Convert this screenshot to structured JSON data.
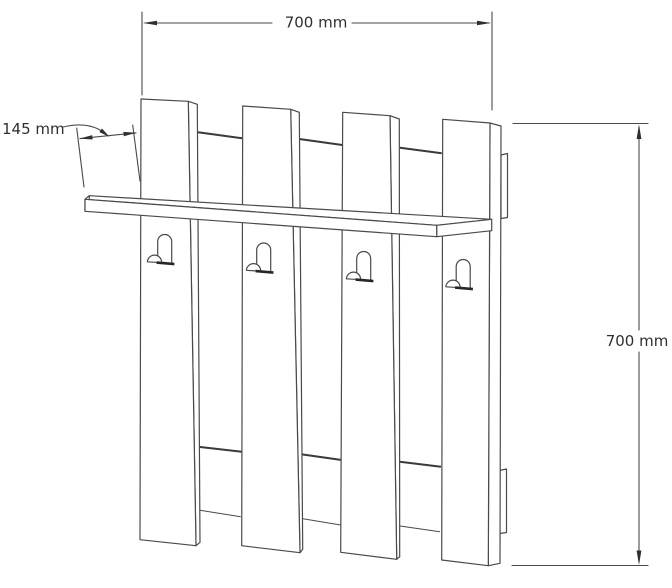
{
  "drawing": {
    "title": "Wall-mounted coat rack technical drawing",
    "dimensions": {
      "width_label": "700 mm",
      "depth_label": "145 mm",
      "height_label": "700 mm"
    },
    "components": {
      "slats": 4,
      "hooks": 4,
      "shelf": 1,
      "wall_rails": 2
    },
    "line_color": "#4a4a4a",
    "text_color": "#2f2f2f",
    "background_color": "#ffffff"
  }
}
